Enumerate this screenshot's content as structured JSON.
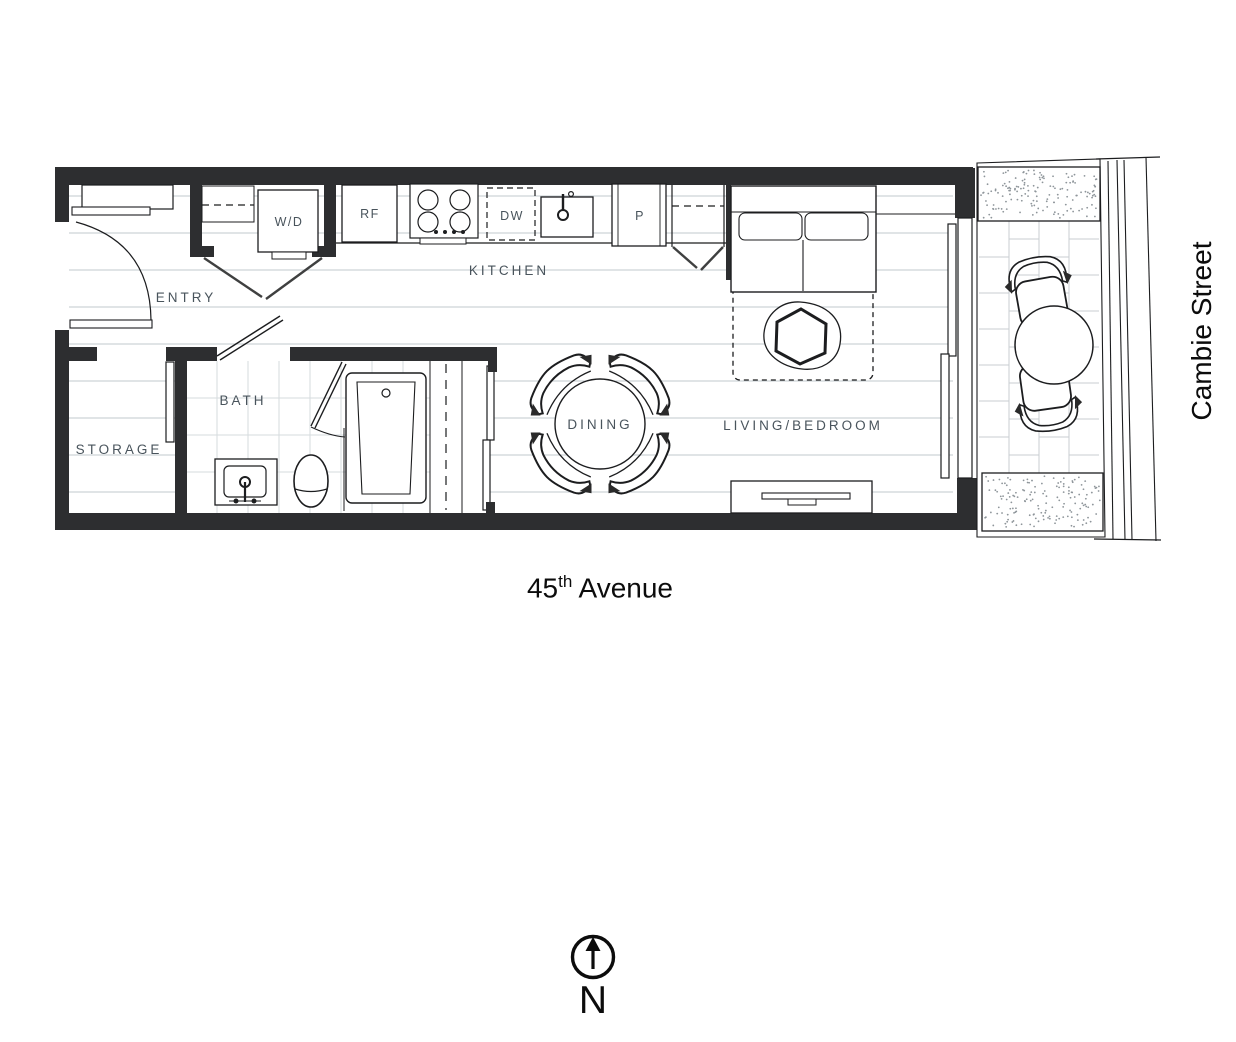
{
  "plan": {
    "rooms": {
      "entry": "ENTRY",
      "kitchen": "KITCHEN",
      "bath": "BATH",
      "storage": "STORAGE",
      "dining": "DINING",
      "living": "LIVING/BEDROOM"
    },
    "appliances": {
      "washer_dryer": "W/D",
      "fridge": "RF",
      "dishwasher": "DW",
      "pantry": "P"
    }
  },
  "streets": {
    "south": {
      "number": "45",
      "ordinal": "th",
      "name": " Avenue"
    },
    "east": "Cambie Street"
  },
  "compass": {
    "north": "N"
  },
  "colors": {
    "wall": "#2d2e30",
    "line": "#1c1d1f",
    "door": "#3f4040",
    "label": "#49545c",
    "floor_line": "#cdd3d7",
    "tile_line": "#d6dbde",
    "paver_line": "#c9ced2",
    "stipple": "#8e959a",
    "text": "#0c0c0c"
  }
}
